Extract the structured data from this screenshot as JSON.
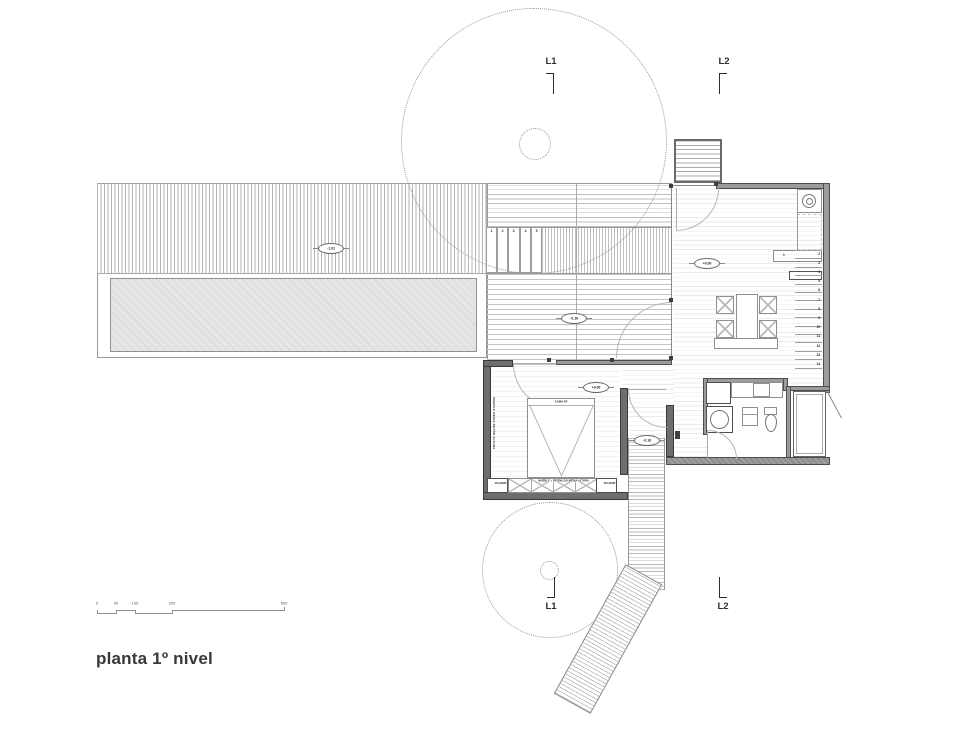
{
  "title": "planta 1º nivel",
  "section_markers": {
    "l1_top": "L1",
    "l2_top": "L2",
    "l1_bottom": "L1",
    "l2_bottom": "L2"
  },
  "elevation_markers": {
    "left_deck": "-1.02",
    "central_deck": "-0.16",
    "living": "+0.00",
    "bedroom": "+0.00",
    "walkway": "-0.16"
  },
  "deck_steps": [
    "1",
    "2",
    "3",
    "4",
    "5"
  ],
  "stair_treads": [
    "1",
    "2",
    "3",
    "4",
    "5",
    "6",
    "7",
    "8",
    "9",
    "10",
    "11",
    "12",
    "13",
    "14"
  ],
  "furniture_labels": {
    "bed": "CAMA 2P",
    "bed_back_unit": "MUEBLE + RESPALDO MEDIA ALTURA",
    "nightstand_left": "VELADOR",
    "nightstand_right": "VELADOR",
    "closet_wall": "MUEBLE MEDIA BETÓN ALTURA"
  },
  "scale_bar": {
    "ticks": [
      "0",
      "50",
      "100",
      "200",
      "500"
    ]
  },
  "colors": {
    "wall": "#9b9b9b",
    "wall_dark": "#6e6e6e",
    "wall_outline": "#4d4d4d",
    "hatch": "#bdbdbd",
    "tree_dotted": "#979797",
    "text": "#383838",
    "background": "#ffffff"
  }
}
